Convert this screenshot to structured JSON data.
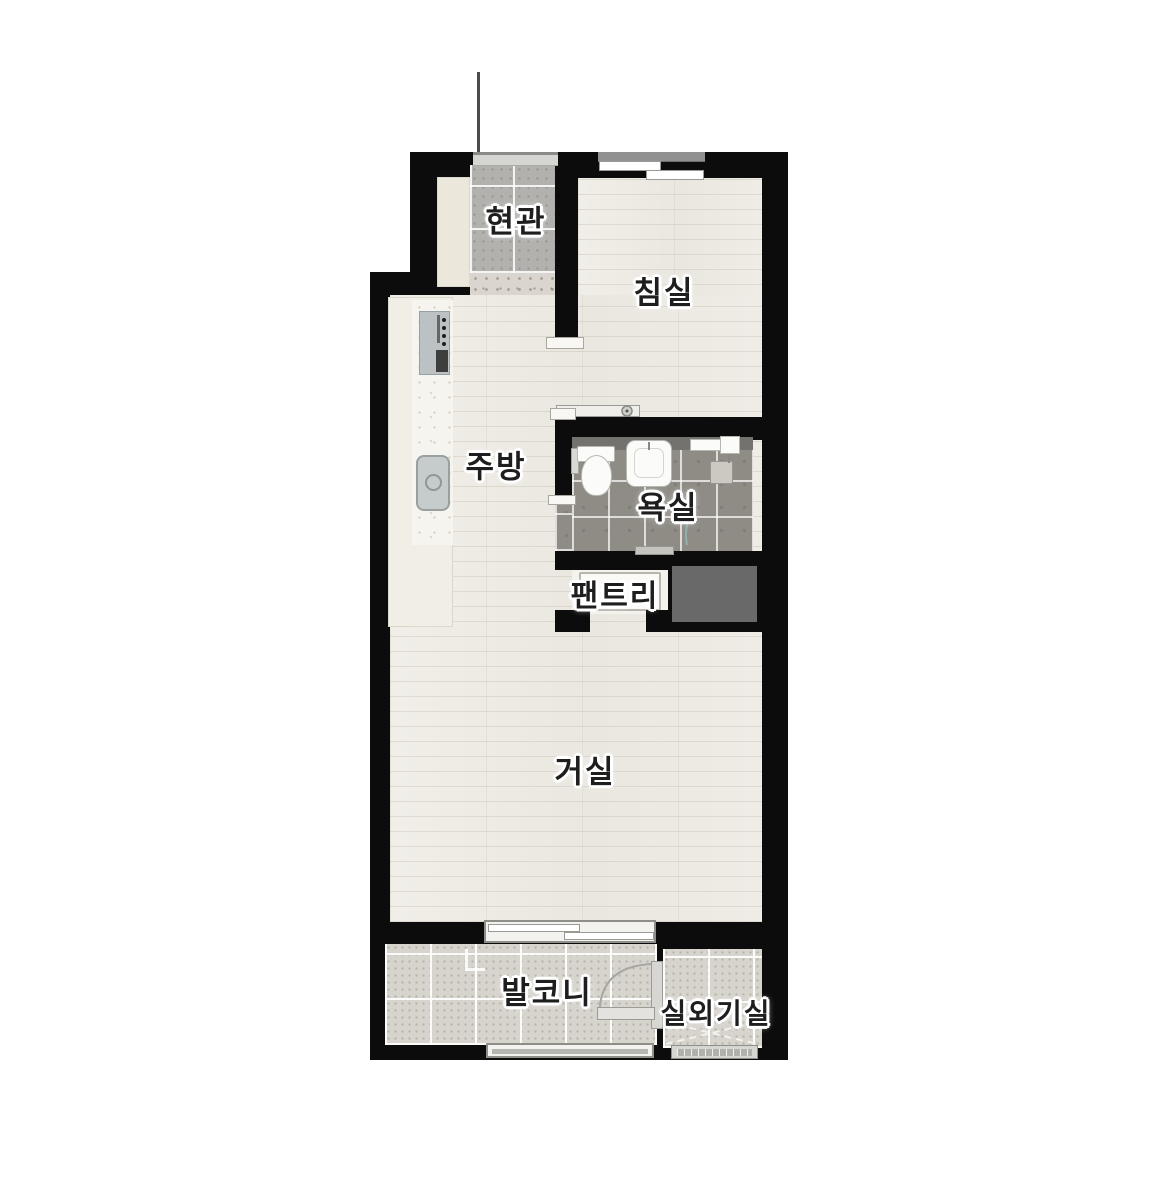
{
  "rooms": {
    "entrance": {
      "label": "현관"
    },
    "bedroom": {
      "label": "침실"
    },
    "kitchen": {
      "label": "주방"
    },
    "bathroom": {
      "label": "욕실"
    },
    "pantry": {
      "label": "팬트리"
    },
    "living_room": {
      "label": "거실"
    },
    "balcony": {
      "label": "발코니"
    },
    "outdoor_unit_room": {
      "label": "실외기실"
    }
  },
  "colors": {
    "background": "#ffffff",
    "wall": "#0c0c0c",
    "wood_floor": "#edebe4",
    "entrance_tile": "#b2b1ae",
    "bathroom_tile": "#8f8c86",
    "balcony_tile": "#d7d4cd",
    "terrazzo": "#dad6cf",
    "kitchen_counter": "#f6f4ee",
    "duct_shaft": "#696969",
    "fixture_white": "#fbfbf9",
    "window_frame": "#8f8f8a"
  }
}
